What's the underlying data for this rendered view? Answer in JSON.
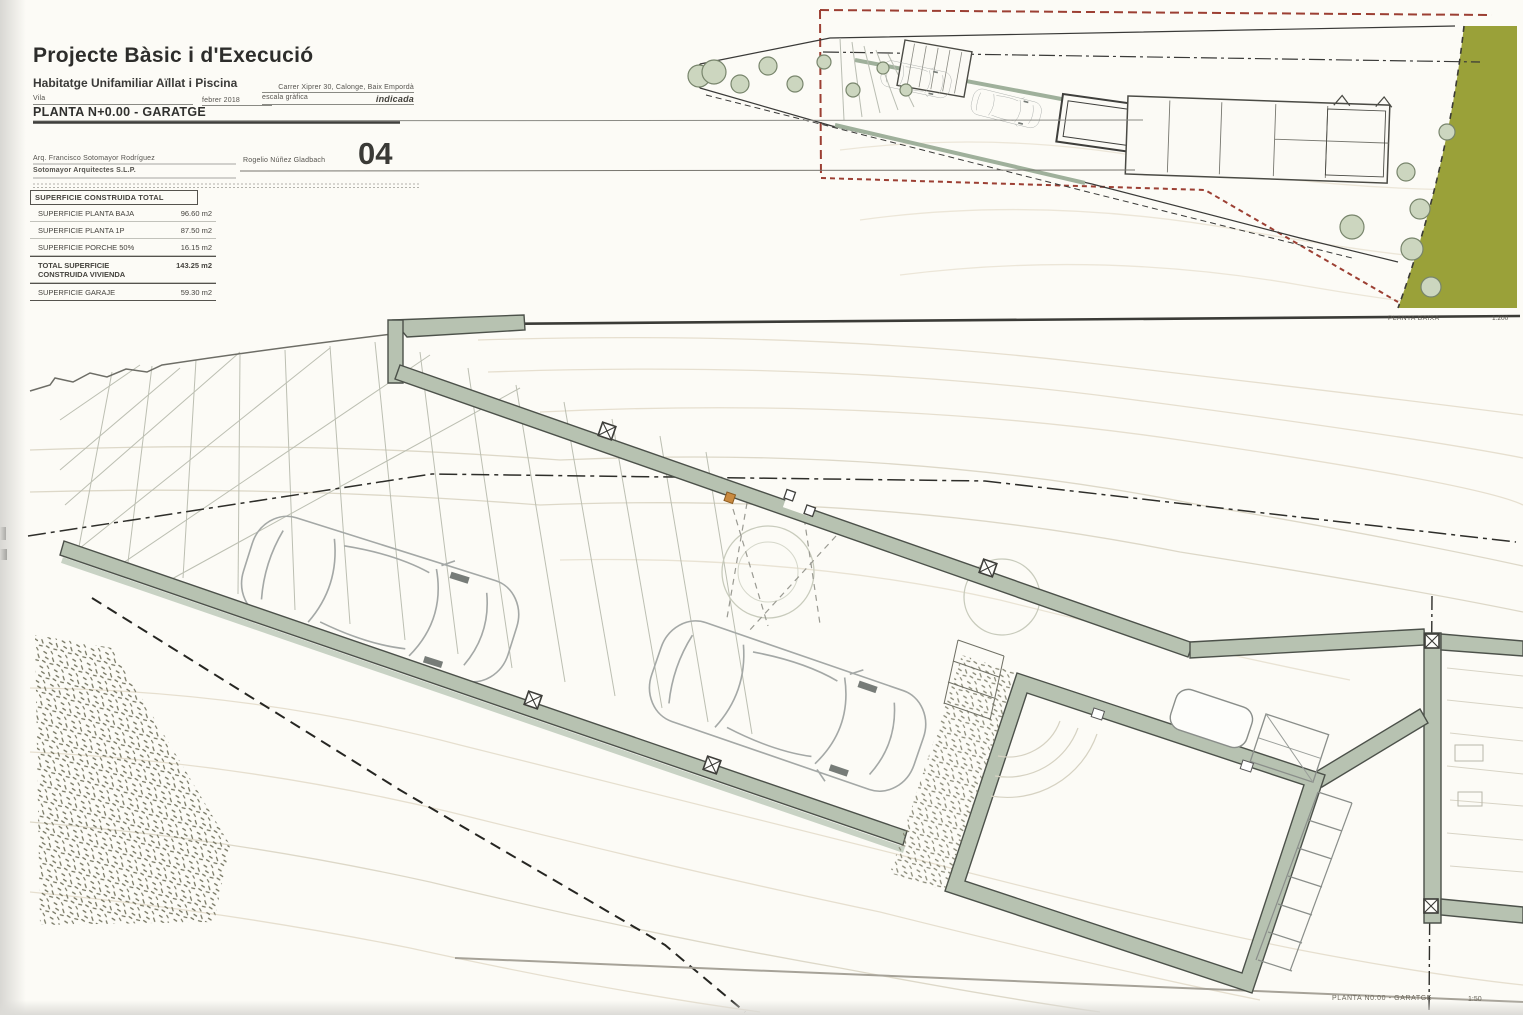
{
  "title_block": {
    "title": "Projecte Bàsic i d'Execució",
    "subtitle": "Habitatge Unifamiliar Aïllat i Piscina",
    "project_ref": "Vila",
    "date": "febrer 2018",
    "address": "Carrer Xiprer 30, Calonge, Baix Empordà",
    "scale_label": "escala gràfica",
    "scale_value": "indicada",
    "plan_name": "PLANTA N+0.00 - GARATGE",
    "architect": "Arq. Francisco Sotomayor Rodríguez",
    "collaborator": "Rogelio Núñez Gladbach",
    "firm": "Sotomayor Arquitectes S.L.P.",
    "sheet_number": "04"
  },
  "areas_table": {
    "header": "SUPERFICIE CONSTRUIDA TOTAL",
    "rows": [
      {
        "label": "SUPERFICIE PLANTA BAJA",
        "value": "96.60 m2"
      },
      {
        "label": "SUPERFICIE PLANTA 1P",
        "value": "87.50 m2"
      },
      {
        "label": "SUPERFICIE PORCHE 50%",
        "value": "16.15 m2"
      },
      {
        "label": "TOTAL SUPERFICIE CONSTRUIDA VIVIENDA",
        "value": "143.25 m2"
      },
      {
        "label": "SUPERFICIE GARAJE",
        "value": "59.30 m2"
      }
    ]
  },
  "site_plan": {
    "label": "PLANTA BAIXA",
    "scale": "1:200"
  },
  "main_plan": {
    "label": "PLANTA N0.00 - GARATGE",
    "scale": "1:50"
  },
  "colors": {
    "wall_fill": "#b7c2b1",
    "wall_stroke": "#4c514a",
    "olive_area": "#9aa139",
    "boundary_red": "#9c3f33",
    "contour": "#e6dfcf",
    "car_outline": "#a4a8a6",
    "paper": "#fcfbf6"
  }
}
